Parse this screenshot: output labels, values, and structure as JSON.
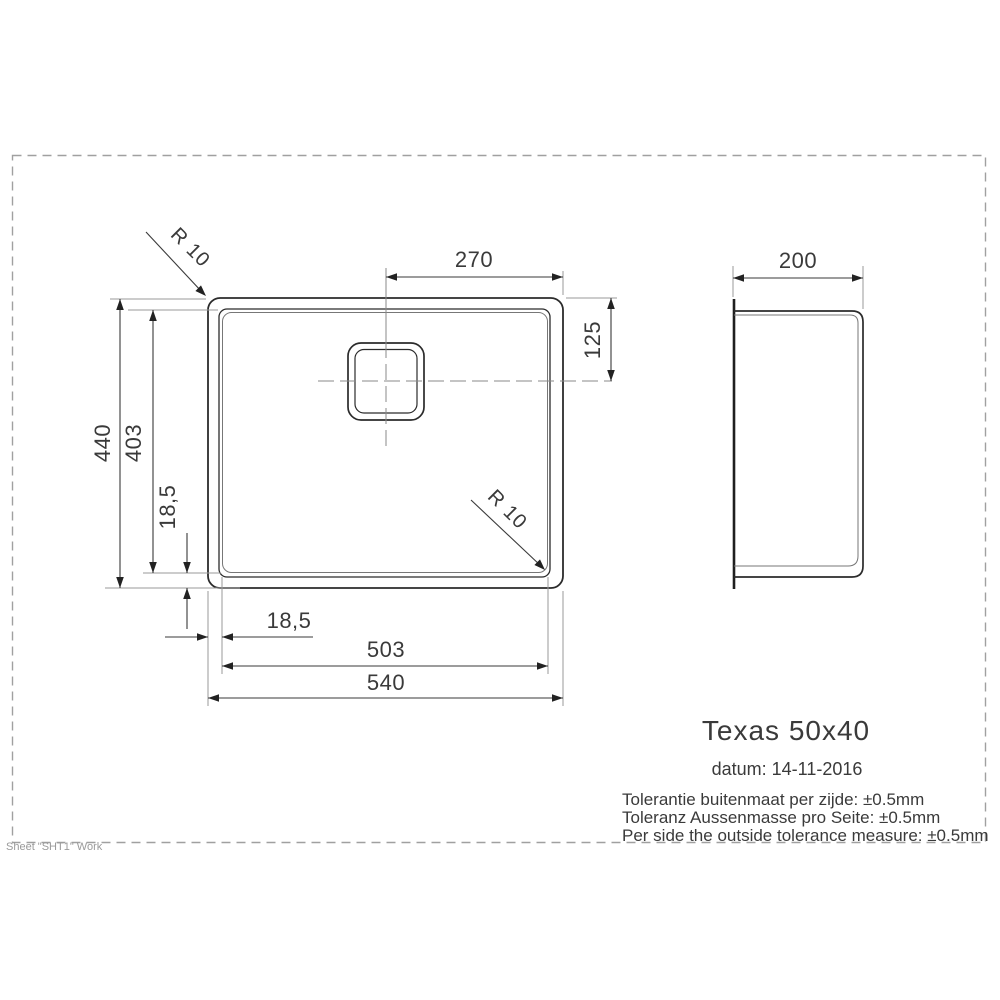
{
  "colors": {
    "object_line": "#2b2b2b",
    "dimension_line": "#3a3a3a",
    "auxiliary_line": "#9a9a9a",
    "text": "#3a3a3a",
    "sheet_text": "#9a9a9a",
    "background": "#ffffff"
  },
  "drawing": {
    "dims": {
      "drain_center_to_right": "270",
      "top_to_drain_center": "125",
      "side_depth": "200",
      "outer_height": "440",
      "bowl_height": "403",
      "rim_inset_vertical": "18,5",
      "rim_inset_horizontal": "18,5",
      "bowl_width": "503",
      "outer_width": "540",
      "corner_radius_top_left": "R 10",
      "corner_radius_bottom_right": "R 10"
    },
    "title_block": {
      "product_name": "Texas 50x40",
      "date_line": "datum: 14-11-2016",
      "tolerances": [
        "Tolerantie buitenmaat per zijde: ±0.5mm",
        "Toleranz Aussenmasse pro Seite: ±0.5mm",
        "Per side the outside tolerance measure: ±0.5mm"
      ]
    },
    "sheet_label": "Sheet \"SHT1\" Work"
  }
}
